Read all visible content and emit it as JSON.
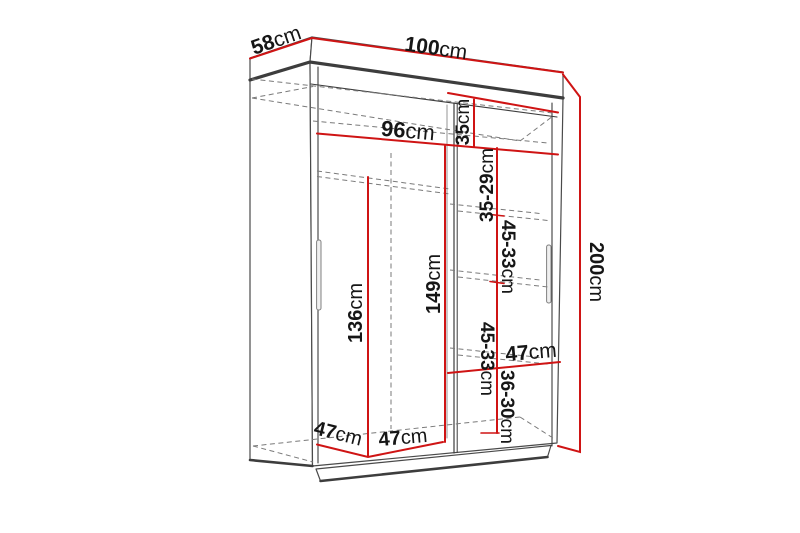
{
  "diagram": {
    "type": "wardrobe-dimension-drawing",
    "colors": {
      "dimension_red": "#cf1414",
      "outline_dark": "#3d3d3d",
      "outline_light": "#6b6b6b",
      "hidden_dashed": "#7a7a7a",
      "label_text": "#161616",
      "background": "#ffffff"
    },
    "dims": {
      "depth_top": {
        "value": "58",
        "unit": "cm"
      },
      "width_top": {
        "value": "100",
        "unit": "cm"
      },
      "interior_width": {
        "value": "96",
        "unit": "cm"
      },
      "top_shelf_height": {
        "value": "35",
        "unit": "cm"
      },
      "gap_35_29": {
        "value": "35-29",
        "unit": "cm"
      },
      "gap_45_33_upper": {
        "value": "45-33",
        "unit": "cm"
      },
      "column_height": {
        "value": "149",
        "unit": "cm"
      },
      "hanging_height": {
        "value": "136",
        "unit": "cm"
      },
      "gap_45_33_lower": {
        "value": "45-33",
        "unit": "cm"
      },
      "shelf_width_right": {
        "value": "47",
        "unit": "cm"
      },
      "gap_36_30": {
        "value": "36-30",
        "unit": "cm"
      },
      "total_height": {
        "value": "200",
        "unit": "cm"
      },
      "bottom_depth_left": {
        "value": "47",
        "unit": "cm"
      },
      "bottom_width_left": {
        "value": "47",
        "unit": "cm"
      }
    }
  }
}
